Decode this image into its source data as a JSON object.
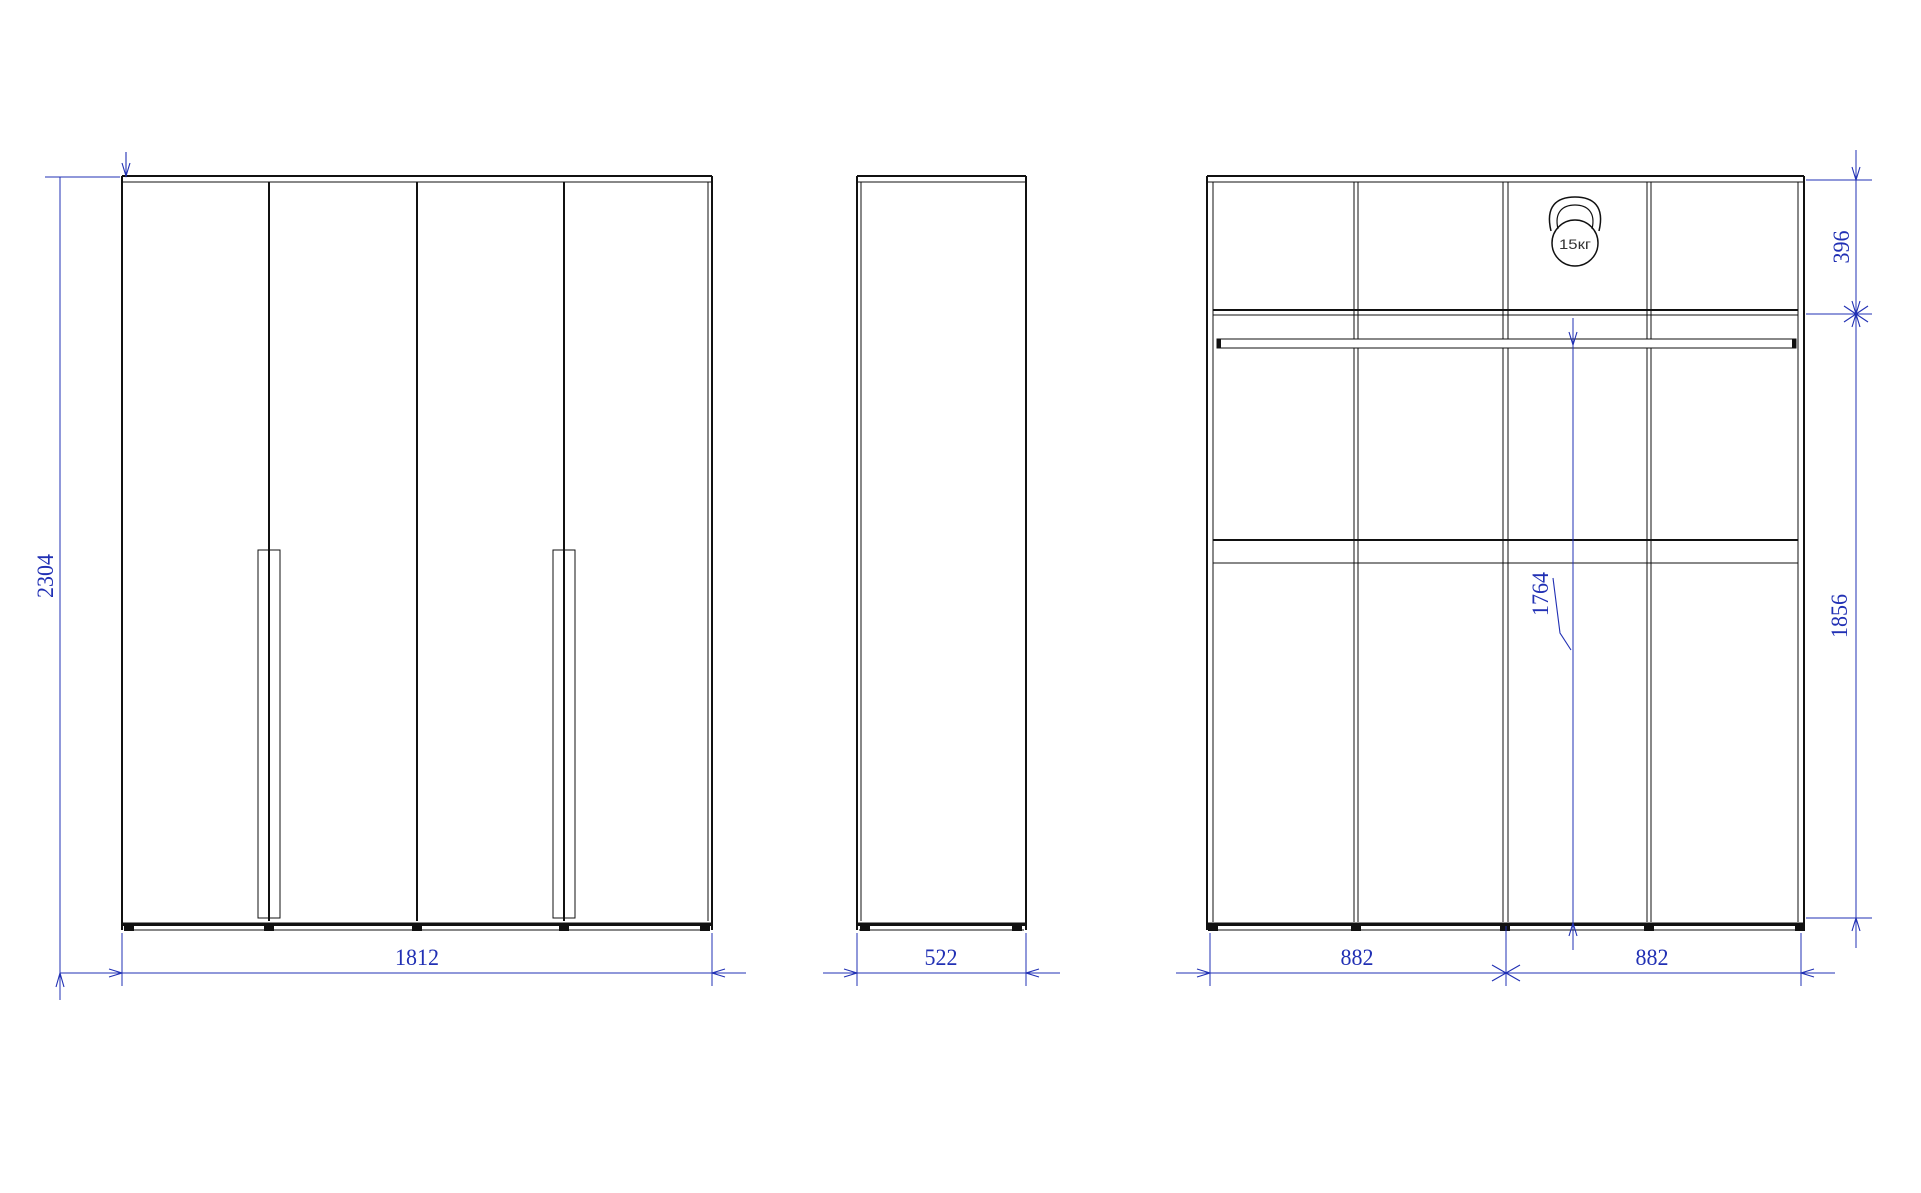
{
  "drawing_type": "wardrobe-technical-drawing",
  "colors": {
    "line": "#111111",
    "dimension": "#2130b4",
    "background": "#ffffff"
  },
  "icons": {
    "max_load": "kettlebell-icon"
  },
  "views": {
    "front": {
      "name": "front view (4 doors)",
      "height_dim": "2304",
      "width_dim": "1812"
    },
    "side": {
      "name": "side view",
      "depth_dim": "522"
    },
    "internal": {
      "name": "internal layout view",
      "top_section_dim": "396",
      "side_height_dim": "1856",
      "rail_height_dim": "1764",
      "left_half_dim": "882",
      "right_half_dim": "882",
      "max_load_label": "15кг"
    }
  }
}
